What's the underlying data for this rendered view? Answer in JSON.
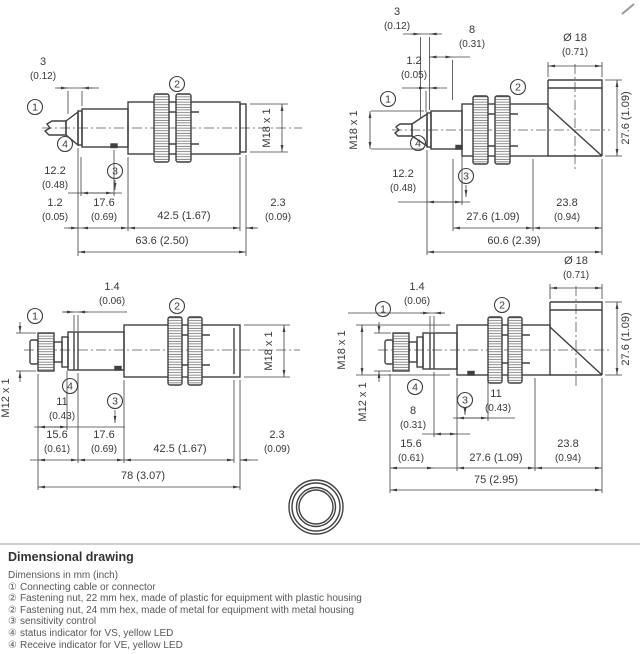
{
  "nums": {
    "n1": "1",
    "n2": "2",
    "n3": "3",
    "n4": "4"
  },
  "d": {
    "tl": {
      "v3": "3",
      "i3": "(0.12)",
      "thread": "M18 x 1",
      "v122": "12.2",
      "i122": "(0.48)",
      "v12": "1.2",
      "i12": "(0.05)",
      "v176": "17.6",
      "i176": "(0.69)",
      "v425": "42.5 (1.67)",
      "v23": "2.3",
      "i23": "(0.09)",
      "total": "63.6 (2.50)"
    },
    "tr": {
      "v3": "3",
      "i3": "(0.12)",
      "v8": "8",
      "i8": "(0.31)",
      "v12": "1.2",
      "i12": "(0.05)",
      "dia": "Ø 18",
      "idia": "(0.71)",
      "vert": "27.6 (1.09)",
      "thread": "M18 x 1",
      "v122": "12.2",
      "i122": "(0.48)",
      "v276": "27.6 (1.09)",
      "v238": "23.8",
      "i238": "(0.94)",
      "total": "60.6 (2.39)"
    },
    "bl": {
      "v14": "1.4",
      "i14": "(0.06)",
      "m12": "M12 x 1",
      "thread": "M18 x 1",
      "v11": "11",
      "i11": "(0.43)",
      "v156": "15.6",
      "i156": "(0.61)",
      "v176": "17.6",
      "i176": "(0.69)",
      "v425": "42.5 (1.67)",
      "v23": "2.3",
      "i23": "(0.09)",
      "total": "78 (3.07)"
    },
    "br": {
      "dia": "Ø 18",
      "idia": "(0.71)",
      "v14": "1.4",
      "i14": "(0.06)",
      "vert": "27.6 (1.09)",
      "m18": "M18 x 1",
      "m12": "M12 x 1",
      "v11": "11",
      "i11": "(0.43)",
      "v8": "8",
      "i8": "(0.31)",
      "v156": "15.6",
      "i156": "(0.61)",
      "v276": "27.6 (1.09)",
      "v238": "23.8",
      "i238": "(0.94)",
      "total": "75 (2.95)"
    }
  },
  "legend": {
    "title": "Dimensional drawing",
    "intro": "Dimensions in mm (inch)",
    "items": [
      {
        "ref": "①",
        "text": "Connecting cable or connector"
      },
      {
        "ref": "②",
        "text": "Fastening nut, 22 mm hex, made of plastic for equipment with plastic housing"
      },
      {
        "ref": "②",
        "text": "Fastening nut, 24 mm hex, made of metal for equipment with metal housing"
      },
      {
        "ref": "③",
        "text": "sensitivity control"
      },
      {
        "ref": "④",
        "text": "status indicator for VS, yellow LED"
      },
      {
        "ref": "④",
        "text": "Receive indicator for VE, yellow LED"
      }
    ]
  }
}
